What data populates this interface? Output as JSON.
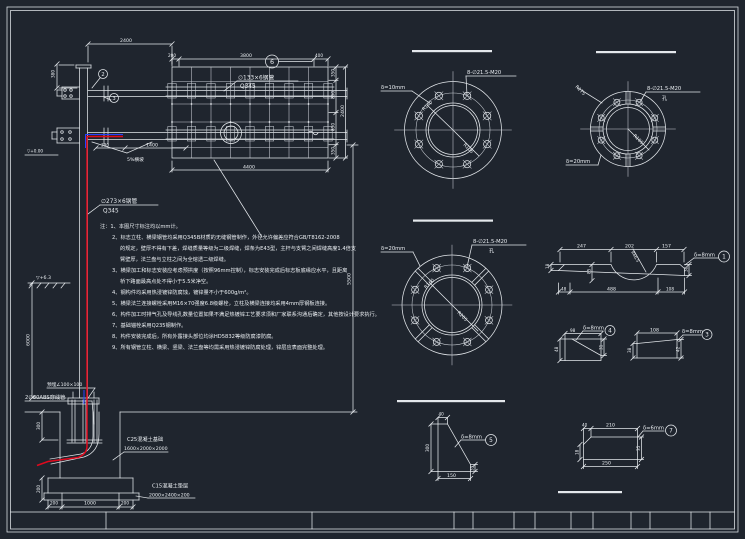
{
  "colors": {
    "background": "#1f252e",
    "line": "#e4e8ec",
    "cable_red": "#e0091d",
    "cable_blue": "#2743ff"
  },
  "labels": {
    "beam_pipe_spec": "∅133×6钢管",
    "beam_pipe_grade": "Q345",
    "pole_pipe_spec": "∅273×6钢管",
    "pole_pipe_grade": "Q345",
    "ground_elev": "▽+6.3",
    "base_elev": "▽+0.00",
    "slope": "5%横坡",
    "embedded_angle": "预埋∠100×100",
    "conduit": "2∅80ABS穿线管",
    "foundation_line1": "C25混凝土基础",
    "foundation_line2": "1600×2000×2000",
    "cushion_line1": "C15混凝土垫层",
    "cushion_line2": "2000×2400×200"
  },
  "dims": {
    "arm_top": "2400",
    "pole_cap": "380",
    "pole_height": "6000",
    "clearance": "5500",
    "brace_a": "390",
    "brace_b": "1400",
    "panel_top_left": "200",
    "panel_top_mid": "3800",
    "panel_top_right": "400",
    "panel_bottom": "4400",
    "panel_r1": "350",
    "panel_r2": "850",
    "panel_r3": "850",
    "panel_r4": "350",
    "panel_total": "2400",
    "found_b1": "200",
    "found_b2": "1000",
    "found_b3": "200",
    "found_l1": "300",
    "found_l2": "200"
  },
  "flange_a": {
    "thickness": "δ=10mm",
    "holes": "8-∅21.5-M20",
    "r_outer": "R140",
    "r_inner": "R105"
  },
  "flange_b": {
    "holes": "8-∅21.5-M20",
    "holes_unit": "孔",
    "thickness": "δ=20mm",
    "r_outer": "R175",
    "r_inner": "R105"
  },
  "flange_c": {
    "thickness": "δ=20mm",
    "holes": "8-∅21.5-M20",
    "holes_unit": "孔",
    "r_outer": "R160",
    "r_inner": "R205"
  },
  "details": {
    "d1": {
      "label": "δ=8mm",
      "num": "1",
      "t1": "247",
      "t2": "202",
      "t3": "157",
      "b1": "48",
      "b2": "488",
      "b3": "108",
      "h1": "18",
      "h2": "85",
      "h3": "38",
      "radius": "R66.5"
    },
    "d3": {
      "label": "δ=8mm",
      "num": "3",
      "top": "108",
      "left": "38",
      "right": "42"
    },
    "d4": {
      "label": "δ=8mm",
      "num": "4",
      "top": "98",
      "left": "48",
      "right": "31"
    },
    "d5": {
      "label": "δ=8mm",
      "num": "5",
      "top": "40",
      "left": "300",
      "bottom": "150",
      "right": "35"
    },
    "d7": {
      "label": "δ=6mm",
      "num": "7",
      "t1": "40",
      "t2": "210",
      "bottom": "250",
      "left": "18",
      "right": "35"
    }
  },
  "callouts": {
    "beam_top": "2",
    "beam_side": "3",
    "panel": "6"
  },
  "notes": {
    "lines": [
      "注：1、本图尺寸标注均以mm计。",
      "2、标志立柱、横梁钢管均采用Q345B材质的无缝钢管制作，外径允许偏差应符合GB/T8162-2008",
      "的规定，壁厚不得有下差，焊缝质量等级为二级焊缝，焊条为E43型，主杆与支臂之间焊缝高度1.4倍支",
      "臂壁厚，法兰盘与立柱之间为全熔透二级焊缝。",
      "3、横梁加工和标志安装应考虑预拱度（按照96mm控制），标志安装完成后标志板底缘应水平，且距离",
      "桥下路面最高点处不得小于5.5米净空。",
      "4、钢构件均采用热浸镀锌防腐蚀，镀锌量不小于600g/m²。",
      "5、横梁法兰连接螺栓采用M16×70强度6.8级螺栓，立柱及横梁连接均采用4mm厚钢板连接。",
      "6、构件加工时排气孔及导线孔数量位置如果不满足热镀锌工艺要求须和厂家联系沟通后确定，其他按设计要求执行。",
      "7、基础锚栓采用Q235钢制作。",
      "8、构件安装完成后，所有外露接头部位均涂HD5832等级防腐漆防腐。",
      "9、所有钢管立柱、横梁、竖梁、法兰盘等均需采用热浸镀锌防腐处理，锌层应表面完整处理。"
    ]
  }
}
